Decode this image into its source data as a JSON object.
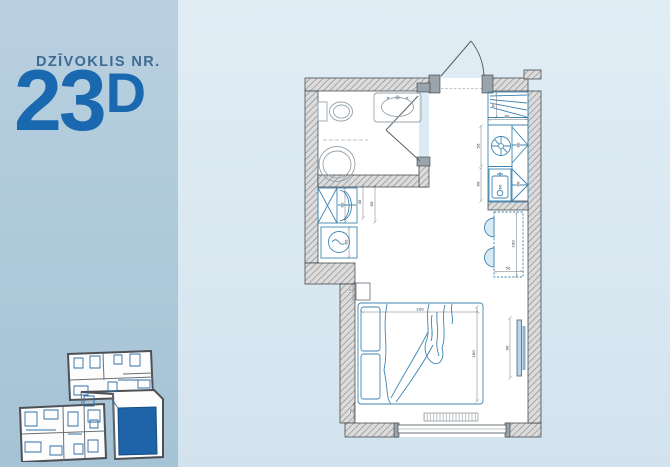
{
  "panel": {
    "label": "DZĪVOKLIS NR.",
    "number": "23",
    "suffix": "D"
  },
  "colors": {
    "accent_number_blue": "#1a68af",
    "label_blue": "#3f6a94",
    "left_background": "#adc9da",
    "right_background": "#dce9f2",
    "furniture_blue": "#3f85b0",
    "overview_highlight": "#1f63a9"
  },
  "floor_plan": {
    "dimensions": [
      {
        "id": "bed-width",
        "text": "200",
        "x": 420,
        "y": 310.6,
        "rot": 0,
        "line": [
          362,
          312,
          478,
          312
        ]
      },
      {
        "id": "bed-depth",
        "text": "160",
        "x": 475.2,
        "y": 354,
        "rot": 90,
        "line": [
          477,
          307,
          477,
          401
        ]
      },
      {
        "id": "tv-height",
        "text": "90",
        "x": 508.6,
        "y": 348,
        "rot": 90,
        "line": [
          510,
          318,
          510,
          378
        ]
      },
      {
        "id": "headboard-shelf",
        "text": "10",
        "x": 351.6,
        "y": 291,
        "rot": 90,
        "line": [
          353,
          283,
          353,
          300
        ]
      },
      {
        "id": "bed-foot-gap",
        "text": "50",
        "x": 352.6,
        "y": 411,
        "rot": 90,
        "line": [
          354,
          403,
          354,
          420
        ]
      },
      {
        "id": "wardrobe-width",
        "text": "60",
        "x": 343.4,
        "y": 205,
        "rot": 90,
        "line": [
          345,
          188,
          345,
          222
        ]
      },
      {
        "id": "closet-gap",
        "text": "45",
        "x": 361.2,
        "y": 202,
        "rot": 90,
        "line": [
          363,
          186,
          363,
          218
        ]
      },
      {
        "id": "closet-clear",
        "text": "60",
        "x": 373.2,
        "y": 204,
        "rot": 90,
        "line": [
          375,
          186,
          375,
          222
        ]
      },
      {
        "id": "washer-width",
        "text": "60",
        "x": 347.4,
        "y": 242,
        "rot": 90,
        "line": [
          349,
          228,
          349,
          257
        ]
      },
      {
        "id": "kitchen-width",
        "text": "60",
        "x": 507,
        "y": 117.4,
        "rot": 0,
        "line": [
          489,
          119.5,
          527,
          119.5
        ]
      },
      {
        "id": "fridge-depth",
        "text": "60",
        "x": 494.6,
        "y": 105,
        "rot": 90,
        "line": [
          496.5,
          93,
          496.5,
          117
        ]
      },
      {
        "id": "kitchen-run-upper",
        "text": "50",
        "x": 479.4,
        "y": 146,
        "rot": 90,
        "line": [
          481,
          126,
          481,
          166
        ]
      },
      {
        "id": "kitchen-run-lower",
        "text": "60",
        "x": 479.4,
        "y": 184,
        "rot": 90,
        "line": [
          481,
          168,
          481,
          201
        ]
      },
      {
        "id": "cabinet-upper",
        "text": "60",
        "x": 519.5,
        "y": 145,
        "rot": 90,
        "line": null
      },
      {
        "id": "cabinet-lower",
        "text": "60",
        "x": 519.5,
        "y": 184,
        "rot": 90,
        "line": null
      },
      {
        "id": "sink-width",
        "text": "60",
        "x": 501.5,
        "y": 187,
        "rot": 90,
        "line": null
      },
      {
        "id": "table-length",
        "text": "100",
        "x": 514.6,
        "y": 244,
        "rot": 90,
        "line": [
          516.5,
          213,
          516.5,
          276
        ]
      },
      {
        "id": "table-width",
        "text": "50",
        "x": 508,
        "y": 269.4,
        "rot": 0,
        "line": [
          495,
          271.5,
          522,
          271.5
        ]
      }
    ]
  }
}
